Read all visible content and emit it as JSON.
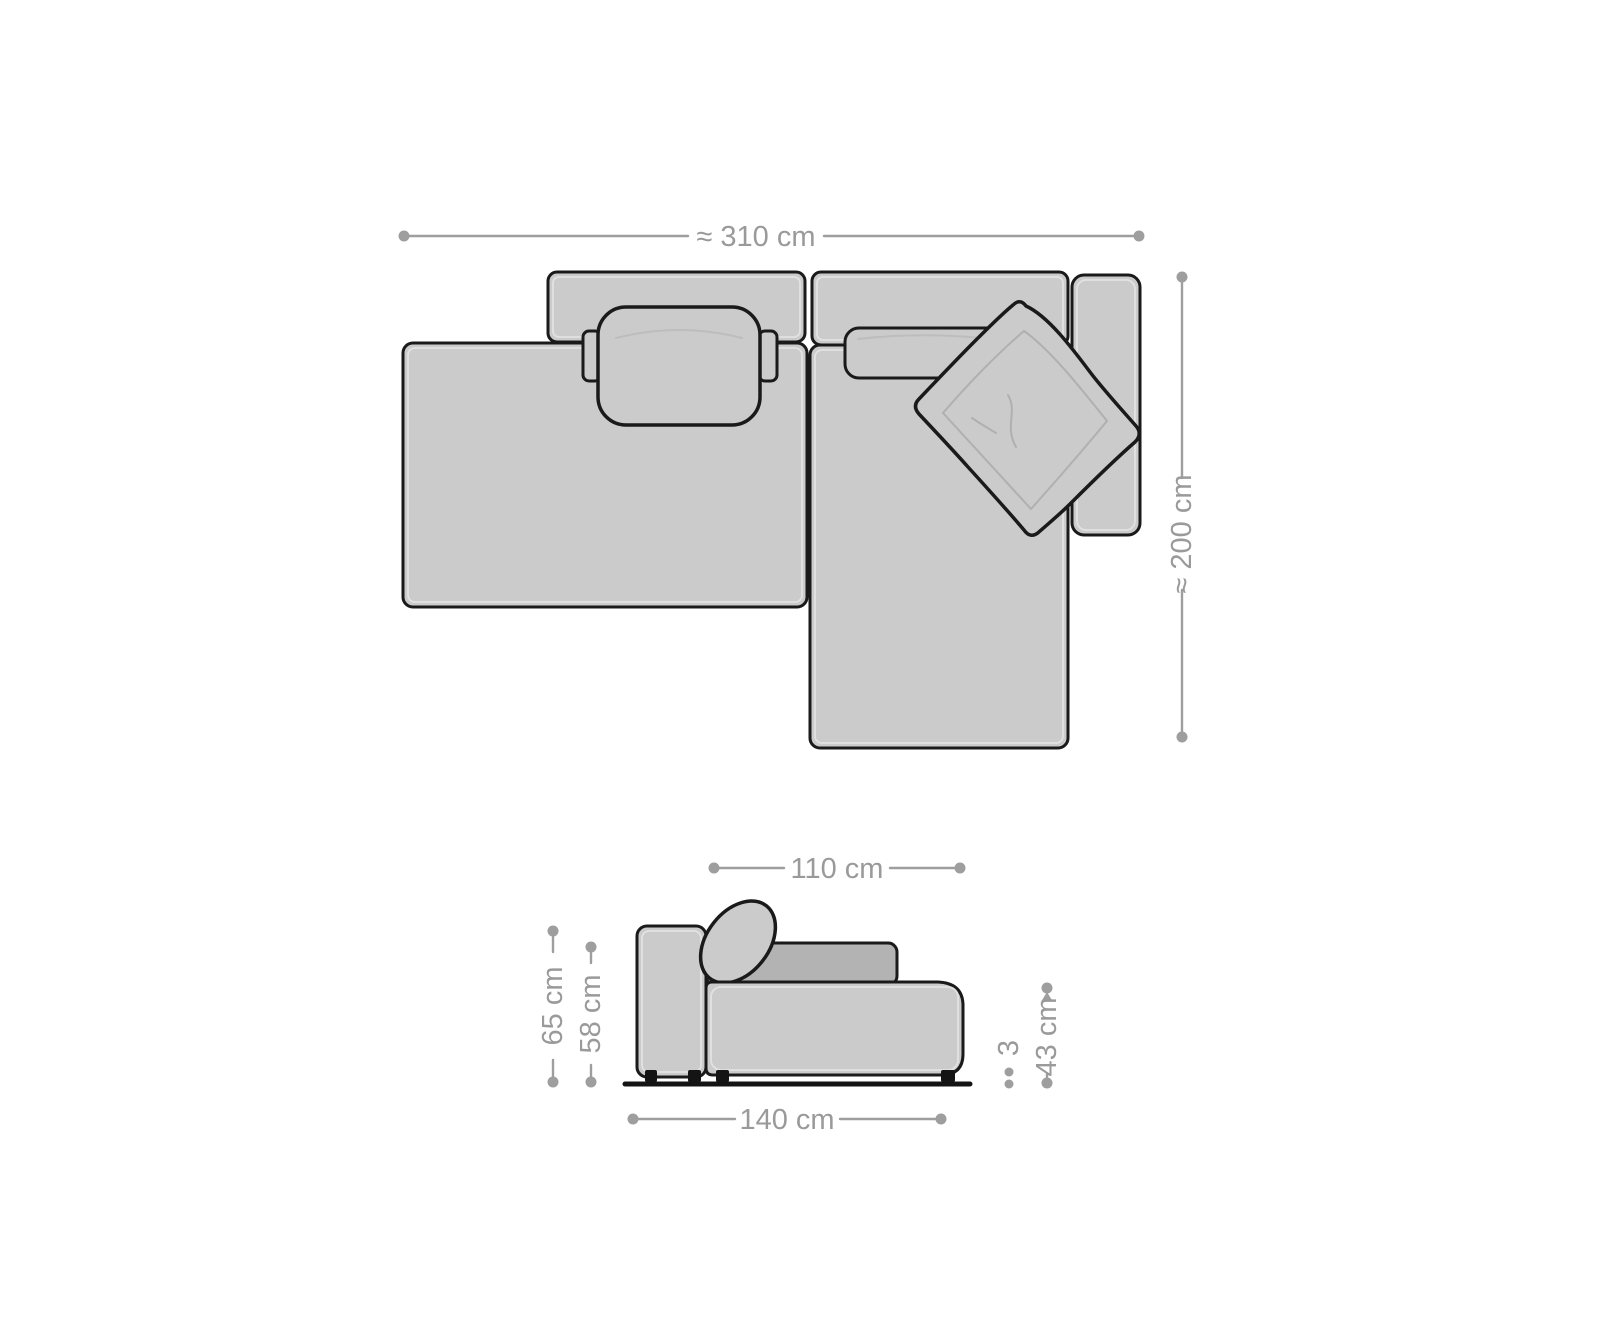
{
  "diagram": {
    "kind": "sofa-dimension-diagram",
    "colors": {
      "background": "#ffffff",
      "outline": "#1a1a1a",
      "body_fill": "#cbcbcb",
      "cushion_dark_fill": "#b3b3b3",
      "dimension_gray": "#9e9e9e",
      "dimension_text": "#9a9a9a"
    },
    "top_view": {
      "dimensions": {
        "width": {
          "label": "≈ 310 cm"
        },
        "depth": {
          "label": "≈ 200 cm"
        }
      }
    },
    "side_view": {
      "dimensions": {
        "seat_depth": {
          "label": "110 cm"
        },
        "total_height": {
          "label": "65 cm"
        },
        "back_height": {
          "label": "58 cm"
        },
        "foot_height": {
          "label": "3"
        },
        "seat_height": {
          "label": "43 cm"
        },
        "total_depth": {
          "label": "140 cm"
        }
      }
    }
  }
}
